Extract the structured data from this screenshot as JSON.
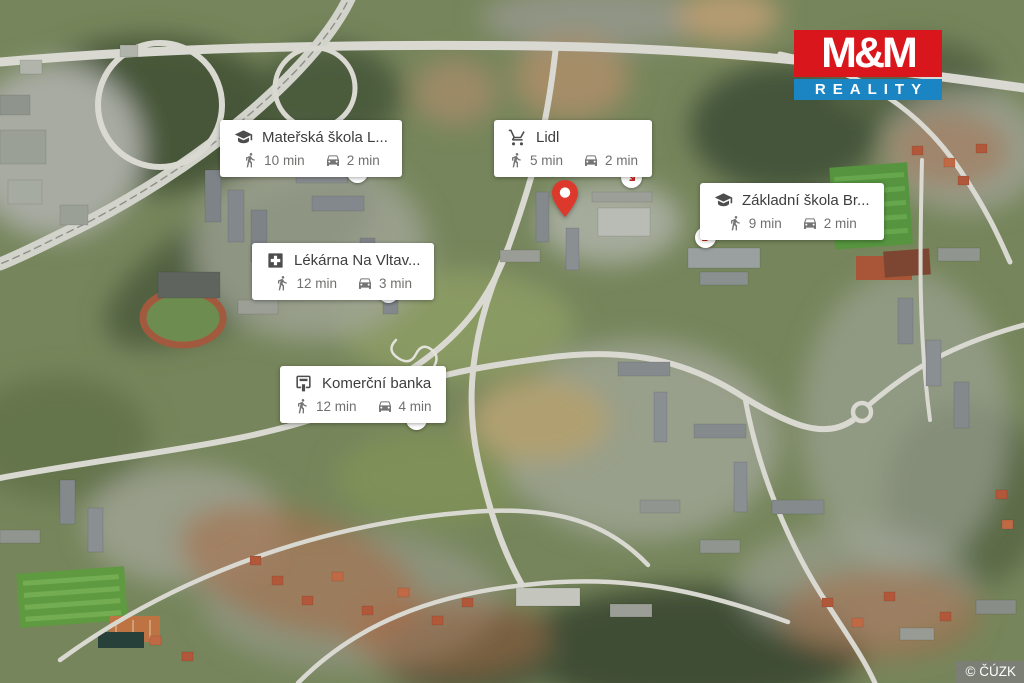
{
  "brand": {
    "name_top": "M&M",
    "name_bottom": "REALITY",
    "red": "#d8161c",
    "blue": "#1b85c4"
  },
  "map": {
    "attribution": "© ČÚZK",
    "pin_color": "#dd382c",
    "arrow_color": "#c5261b"
  },
  "callouts": [
    {
      "id": "materska-skola",
      "icon": "graduation-cap-icon",
      "label": "Mateřská škola L...",
      "walk_time": "10 min",
      "drive_time": "2 min",
      "arrow_direction": "down-right"
    },
    {
      "id": "lidl",
      "icon": "shopping-cart-icon",
      "label": "Lidl",
      "walk_time": "5 min",
      "drive_time": "2 min",
      "arrow_direction": "down-right"
    },
    {
      "id": "zakladni-skola",
      "icon": "graduation-cap-icon",
      "label": "Základní škola Br...",
      "walk_time": "9 min",
      "drive_time": "2 min",
      "arrow_direction": "down-left"
    },
    {
      "id": "lekarna",
      "icon": "first-aid-cross-icon",
      "label": "Lékárna Na Vltav...",
      "walk_time": "12 min",
      "drive_time": "3 min",
      "arrow_direction": "down-right"
    },
    {
      "id": "komercni-banka",
      "icon": "atm-bank-icon",
      "label": "Komerční banka",
      "walk_time": "12 min",
      "drive_time": "4 min",
      "arrow_direction": "down-right"
    }
  ]
}
